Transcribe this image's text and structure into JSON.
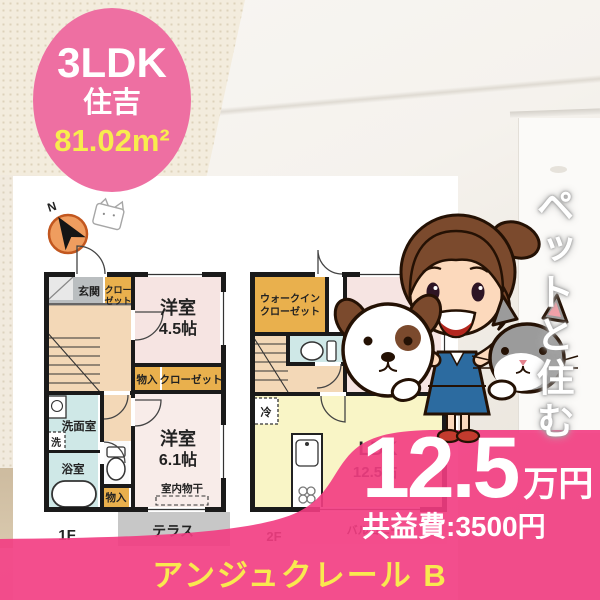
{
  "badge": {
    "layout": "3LDK",
    "location": "住吉",
    "area": "81.02m²"
  },
  "side_banner": {
    "text": "ペットと住む"
  },
  "price": {
    "rent": "12.5",
    "rent_unit": "万円",
    "common_fee": "共益費:3500円"
  },
  "footer": {
    "property_name": "アンジュクレール B"
  },
  "floorplan": {
    "compass_label": "N",
    "floor1": {
      "floor_label": "1F",
      "entrance": "玄関",
      "closet_line1": "クロー",
      "closet_line2": "ゼット",
      "room1_name": "洋室",
      "room1_size": "4.5帖",
      "storage1": "物入",
      "closet2": "クローゼット",
      "room2_name": "洋室",
      "room2_size": "6.1帖",
      "indoor_drying": "室内物干",
      "washroom": "洗面室",
      "washer": "洗",
      "bathroom": "浴室",
      "storage2": "物入",
      "terrace": "テラス"
    },
    "floor2": {
      "floor_label": "2F",
      "walkin_line1": "ウォークイン",
      "walkin_line2": "クローゼット",
      "fridge": "冷",
      "ldk_name": "LDK",
      "ldk_size": "12.5帖",
      "balcony": "バルコニー"
    }
  },
  "colors": {
    "badge_pink": "#ee6fa2",
    "overlay_pink": "#f23d82",
    "accent_yellow": "#f9e94f",
    "plan_orange": "#e9b04d",
    "ldk_yellow": "#f9f5c6",
    "room_pink": "#f6e4e2",
    "wet_cyan": "#cfe8e7",
    "hall_peach": "#f3d8b7"
  }
}
